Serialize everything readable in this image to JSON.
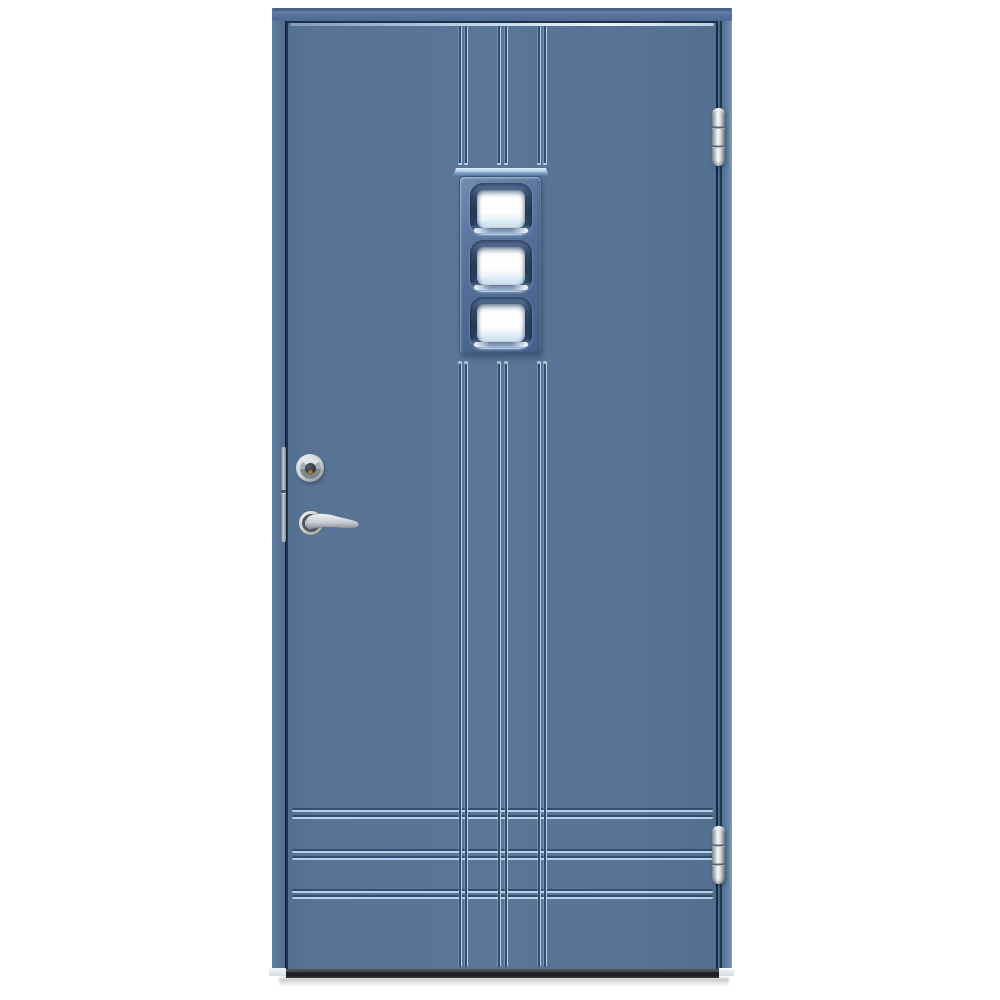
{
  "scene": {
    "type": "product-photo",
    "description": "Front view of a blue exterior entry door with three square glazing panes in a vertical window, vertical and horizontal decorative grooves, a stainless steel lever handle, a cylinder lock, a lock faceplate on the door edge, two barrel hinges on the right side, and a dark threshold, photographed on a white background.",
    "background_color": "#ffffff"
  },
  "colors": {
    "background": "#ffffff",
    "leaf": "#587394",
    "frame": "#5c789a",
    "groove-dark": "#334c6f",
    "groove-light": "#b6d0e8",
    "highlight": "#d9e9f7",
    "window-face": "#526d95",
    "window-border": "#3b5781",
    "pane-frame": "#263a54",
    "glass": "#fbfdfe",
    "glass-tint": "#c9e0f0",
    "metal-light": "#eff1f3",
    "metal": "#c3c9ce",
    "metal-dark": "#787f86",
    "threshold": "#24272b",
    "keyhole": "#8a6a28"
  },
  "door": {
    "glazing_pane_count": 3,
    "vertical_groove_pairs": 3,
    "horizontal_groove_pairs": 3,
    "hinge_count": 2,
    "hardware": [
      "top-hinge",
      "bottom-hinge",
      "cylinder-lock",
      "lever-handle",
      "lock-faceplate"
    ]
  }
}
